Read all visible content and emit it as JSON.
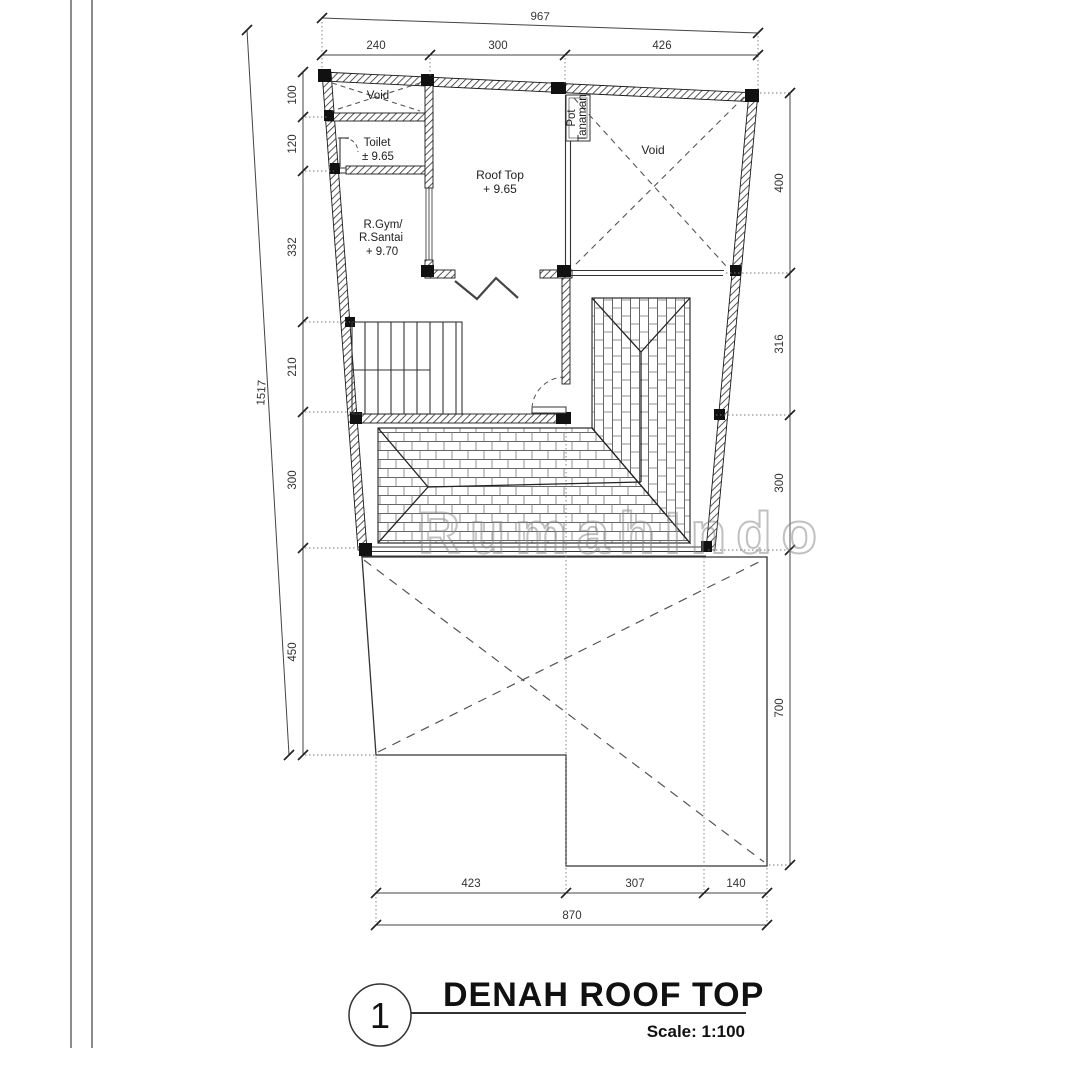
{
  "drawing": {
    "number": "1",
    "title": "DENAH  ROOF TOP",
    "scale_label": "Scale: 1:100",
    "watermark": "RumahIndo"
  },
  "rooms": {
    "void_top": "Void",
    "void_right": "Void",
    "toilet_name": "Toilet",
    "toilet_level": "± 9.65",
    "rooftop_name": "Roof Top",
    "rooftop_level": "+ 9.65",
    "gym_line1": "R.Gym/",
    "gym_line2": "R.Santai",
    "gym_level": "+ 9.70",
    "planter_line1": "Pot",
    "planter_line2": "Tanaman"
  },
  "dimensions": {
    "top_total": "967",
    "top_seg_0": "240",
    "top_seg_1": "300",
    "top_seg_2": "426",
    "left_total": "1517",
    "left_seg_0": "100",
    "left_seg_1": "120",
    "left_seg_2": "332",
    "left_seg_3": "210",
    "left_seg_4": "300",
    "left_seg_5": "450",
    "right_seg_0": "400",
    "right_seg_1": "316",
    "right_seg_2": "300",
    "right_seg_3": "700",
    "bottom_seg_0": "423",
    "bottom_seg_1": "307",
    "bottom_seg_2": "140",
    "bottom_total": "870"
  }
}
